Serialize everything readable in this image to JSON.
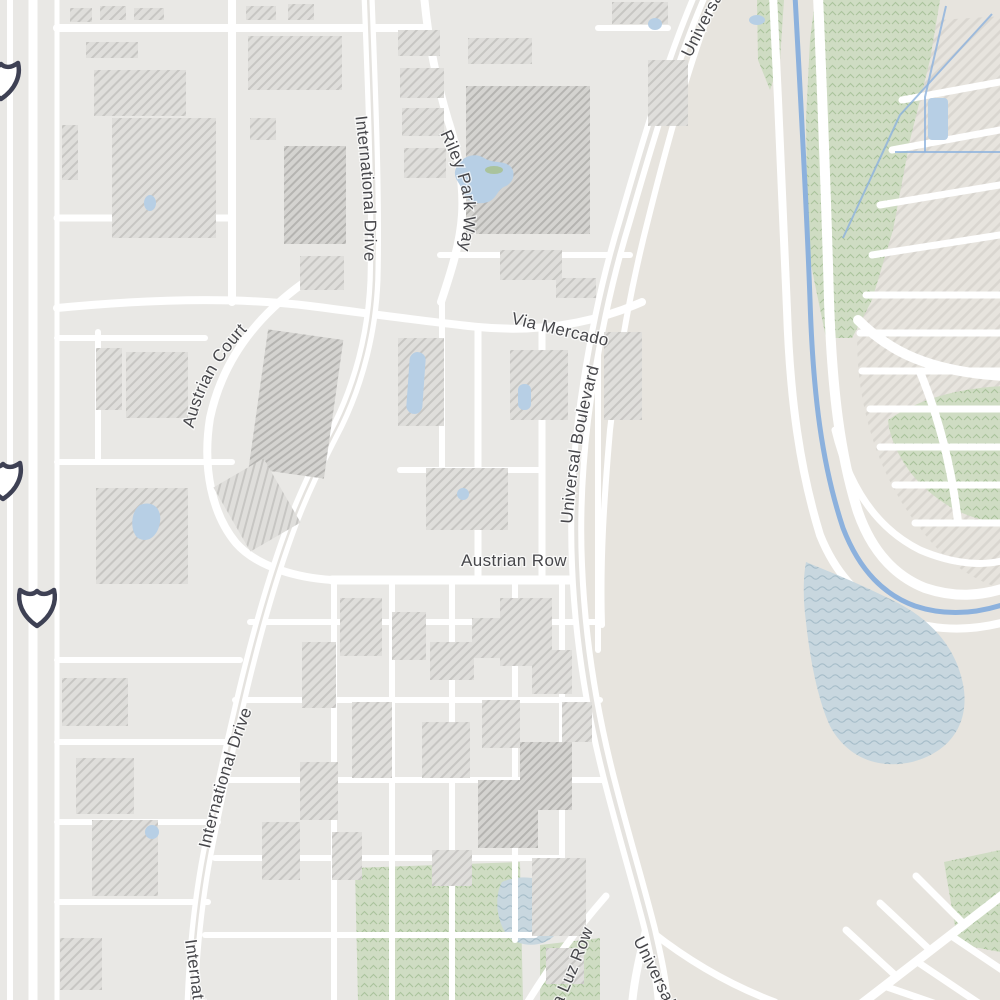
{
  "map": {
    "type": "street-map",
    "labels": {
      "international_drive": "International Drive",
      "riley_park_way": "Riley Park Way",
      "via_mercado": "Via Mercado",
      "universal_boulevard": "Universal Boulevard",
      "austrian_court": "Austrian Court",
      "austrian_row": "Austrian Row",
      "la_luz_row": "La Luz Row"
    },
    "icons": {
      "highway_shield": "blank-interstate-shield",
      "highway_shield_count": 3
    },
    "colors": {
      "land": "#e9e8e5",
      "district": "#e7e4de",
      "road": "#ffffff",
      "building_fill": "#dfdedb",
      "building_hatch": "#c7c6c3",
      "building_dark_fill": "#d4d3d0",
      "building_dark_hatch": "#b5b4b1",
      "green_fill": "#cfdcc3",
      "green_texture": "#aac39c",
      "parking_fill": "#e7e4de",
      "parking_hatch": "#d9d6d0",
      "water_line": "#8cb1dd",
      "water_fill": "#c8d7df",
      "water_wave": "#a6bdc9",
      "pond_fill": "#b7cfe5",
      "label_text": "#47474b",
      "shield_outline": "#3e4154",
      "shield_fill": "#ffffff",
      "median": "#e5e3df"
    }
  }
}
